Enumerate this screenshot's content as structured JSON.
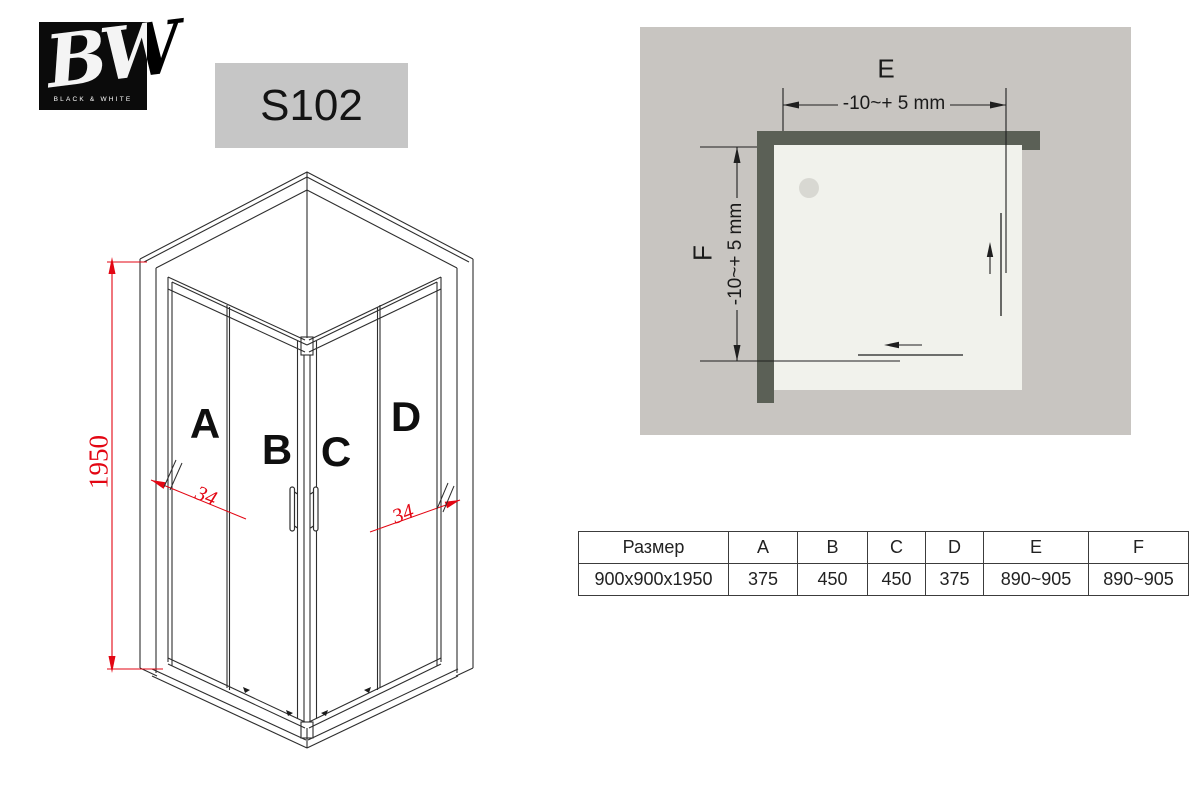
{
  "logo": {
    "initials": "BW",
    "caption": "BLACK & WHITE"
  },
  "model": {
    "code": "S102"
  },
  "iso": {
    "panel_labels": {
      "a": "A",
      "b": "B",
      "c": "C",
      "d": "D"
    },
    "height_dim": "1950",
    "angle_left": "34",
    "angle_right": "34",
    "dim_color": "#e30613",
    "line_color": "#2e2e2e"
  },
  "plan": {
    "label_e": "E",
    "label_f": "F",
    "dim_e": "-10~+ 5 mm",
    "dim_f": "-10~+ 5 mm",
    "colors": {
      "panel": "#c8c5c1",
      "tray": "#f1f2ec",
      "wall": "#5b6056",
      "drain": "#d8d8d2"
    }
  },
  "table": {
    "headers": [
      "Размер",
      "A",
      "B",
      "C",
      "D",
      "E",
      "F"
    ],
    "row": [
      "900x900x1950",
      "375",
      "450",
      "450",
      "375",
      "890~905",
      "890~905"
    ]
  }
}
